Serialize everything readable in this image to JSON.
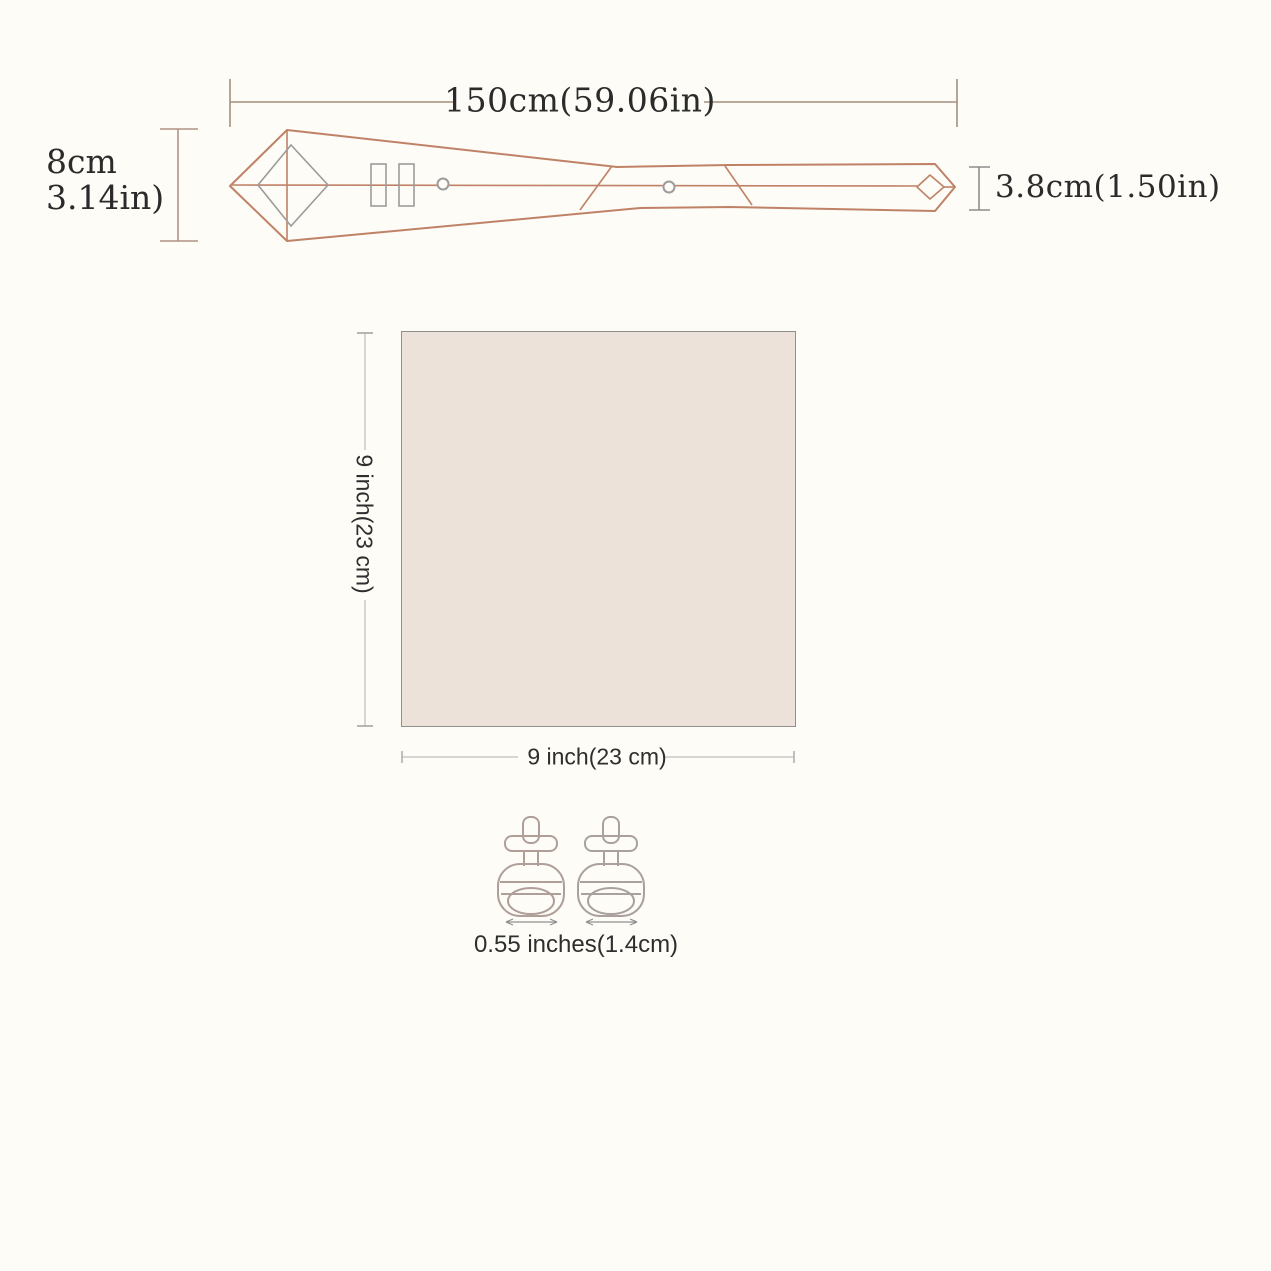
{
  "page": {
    "background_color": "#fdfcf7",
    "description_labels": {
      "tie_length": "150cm(59.06in)",
      "tie_wide_end_line1": "8cm",
      "tie_wide_end_line2": "3.14in)",
      "tie_narrow_end": "3.8cm(1.50in)",
      "square_height": "9 inch(23 cm)",
      "square_width": "9 inch(23 cm)",
      "cufflink_size": "0.55 inches(1.4cm)"
    }
  },
  "tie": {
    "length_label": "150cm(59.06in)",
    "width_label_line1": "8cm",
    "width_label_line2": "3.14in)",
    "tail_width_label": "3.8cm(1.50in)",
    "outline_color": "#c0online8267",
    "accent_outline_hex": "#c08267",
    "secondary_gray_hex": "#9c9c9c",
    "dimension_line_hex": "#a3907f"
  },
  "pocket_square": {
    "height_label": "9 inch(23 cm)",
    "width_label": "9 inch(23 cm)",
    "fill_hex": "#ece2da",
    "border_hex": "#8f8f8f",
    "dimension_line_hex": "#c9c9c9"
  },
  "cufflinks": {
    "size_label": "0.55 inches(1.4cm)",
    "count": 2,
    "outline_hex": "#b09e99",
    "arrow_hex": "#8f8f8f"
  }
}
